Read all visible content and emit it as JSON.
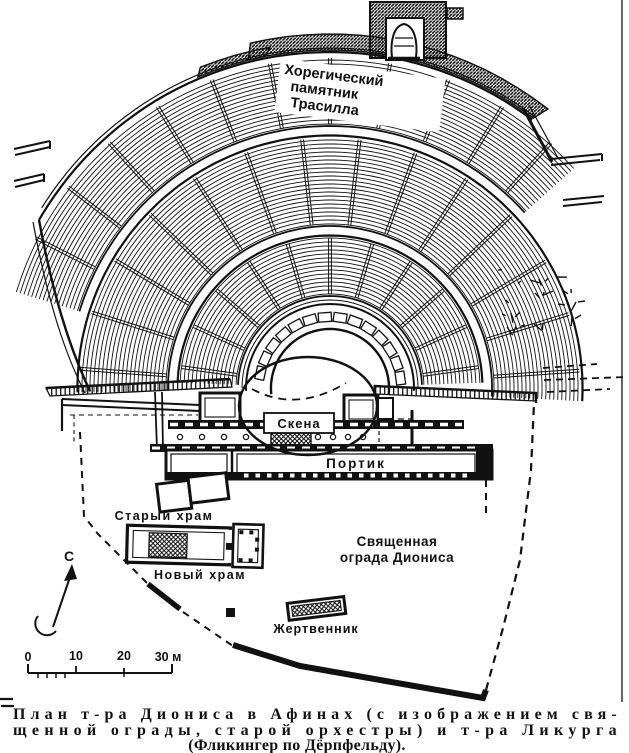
{
  "map": {
    "monument_label": {
      "line1": "Хорегический",
      "line2": "памятник",
      "line3": "Трасилла"
    },
    "skene_label": "Скена",
    "portico_label": "Портик",
    "old_temple_label": "Старый храм",
    "new_temple_label": "Новый храм",
    "enclosure_label": {
      "line1": "Священная",
      "line2": "ограда Диониса"
    },
    "altar_label": "Жертвенник",
    "compass_label": "С"
  },
  "scale_bar": {
    "t0": "0",
    "t10": "10",
    "t20": "20",
    "t30": "30 м"
  },
  "caption": {
    "line1": "План т-ра Диониса в Афинах (с изображением свя-",
    "line2": "щенной ограды, старой орхестры) и т-ра Ликурга",
    "line3": "(Фликингер по Дёрпфельду)."
  },
  "colors": {
    "ink": "#111111",
    "paper": "#ffffff"
  }
}
